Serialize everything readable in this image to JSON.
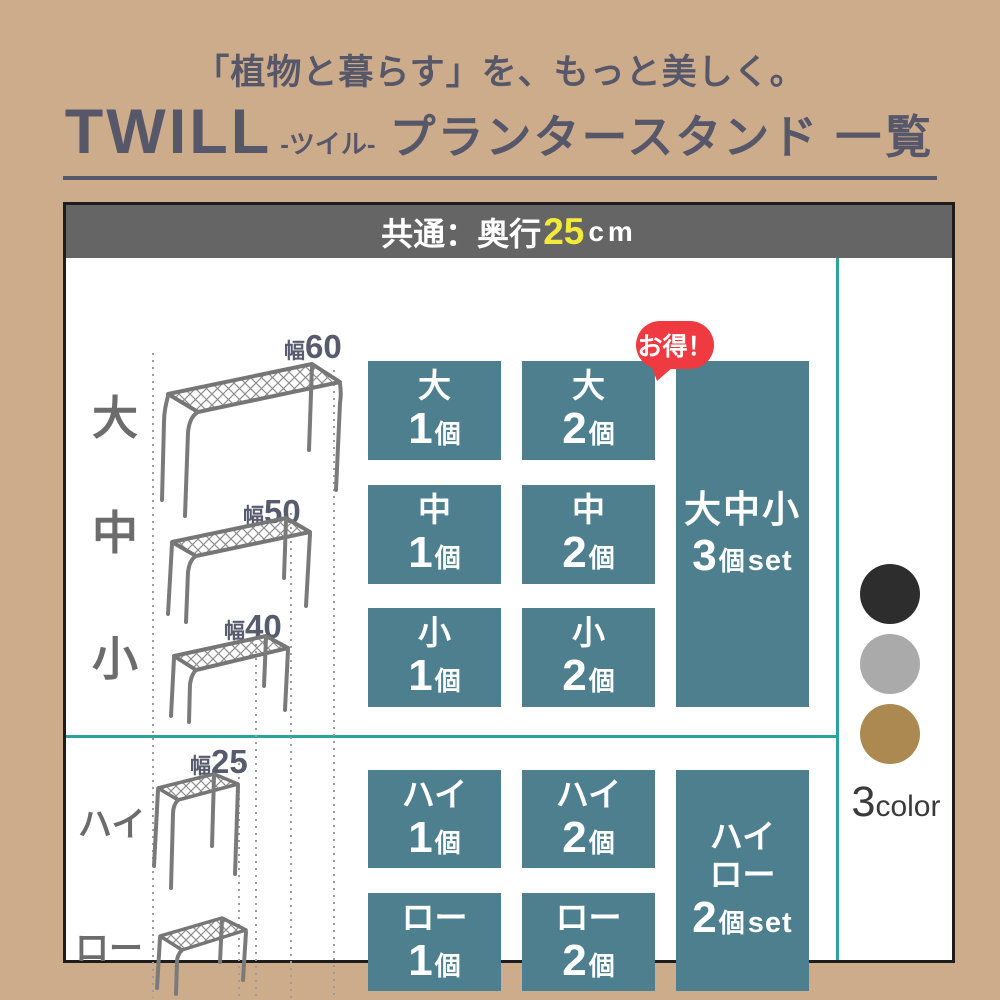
{
  "header": {
    "subtitle": "「植物と暮らす」を、もっと美しく。",
    "brand": "TWILL",
    "brand_reading": "-ツイル-",
    "product": "プランタースタンド",
    "suffix": "一覧"
  },
  "panel": {
    "spec_bar": {
      "prefix": "共通：奥行",
      "highlight": "25",
      "suffix": "cm"
    },
    "badge": "お得！",
    "sizes": {
      "labels": [
        "大",
        "中",
        "小"
      ],
      "widths": [
        {
          "prefix": "幅",
          "value": "60"
        },
        {
          "prefix": "幅",
          "value": "50"
        },
        {
          "prefix": "幅",
          "value": "40"
        }
      ],
      "items": [
        {
          "size": "大",
          "count": "1",
          "unit": "個"
        },
        {
          "size": "大",
          "count": "2",
          "unit": "個"
        },
        {
          "size": "中",
          "count": "1",
          "unit": "個"
        },
        {
          "size": "中",
          "count": "2",
          "unit": "個"
        },
        {
          "size": "小",
          "count": "1",
          "unit": "個"
        },
        {
          "size": "小",
          "count": "2",
          "unit": "個"
        }
      ],
      "set": {
        "title": "大中小",
        "count": "3",
        "unit": "個",
        "suffix": "set"
      }
    },
    "heights": {
      "labels": [
        "ハイ",
        "ロー"
      ],
      "width": {
        "prefix": "幅",
        "value": "25"
      },
      "items": [
        {
          "size": "ハイ",
          "count": "1",
          "unit": "個"
        },
        {
          "size": "ハイ",
          "count": "2",
          "unit": "個"
        },
        {
          "size": "ロー",
          "count": "1",
          "unit": "個"
        },
        {
          "size": "ロー",
          "count": "2",
          "unit": "個"
        }
      ],
      "set": {
        "line1": "ハイ",
        "line2": "ロー",
        "count": "2",
        "unit": "個",
        "suffix": "set"
      }
    },
    "colors": {
      "count": "3",
      "label": "color",
      "swatches": [
        {
          "name": "black",
          "hex": "#2d2d2d"
        },
        {
          "name": "gray",
          "hex": "#aaaaaa"
        },
        {
          "name": "gold",
          "hex": "#ac8950"
        }
      ]
    }
  }
}
